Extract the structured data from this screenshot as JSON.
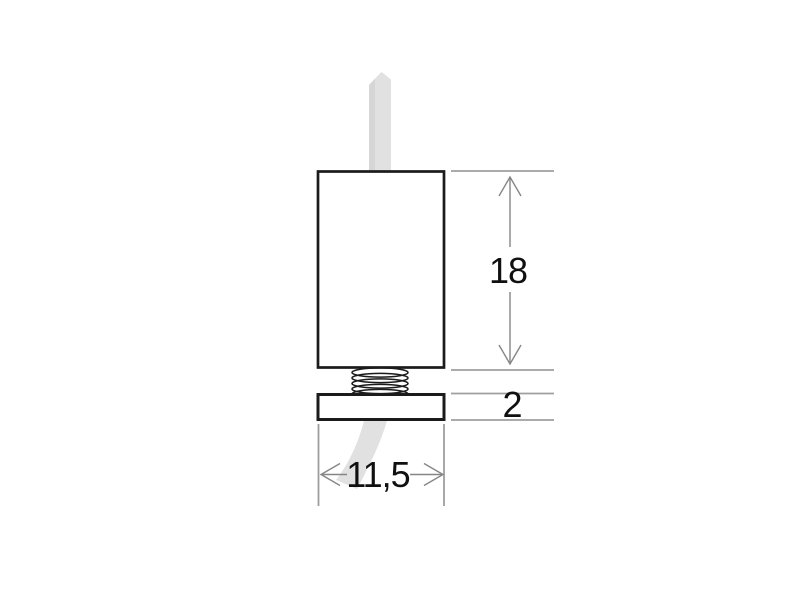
{
  "canvas": {
    "width": 800,
    "height": 600
  },
  "drawing": {
    "labels": {
      "height": "18",
      "plate_thickness": "2",
      "width": "11,5"
    },
    "colors": {
      "outline": "#1b1b1b",
      "dim": "#868686",
      "ext": "#9f9f9f",
      "ribbon": "#e1e1e1",
      "ribbonDark": "#d6d6d6",
      "text": "#101010",
      "bg": "#ffffff"
    }
  }
}
